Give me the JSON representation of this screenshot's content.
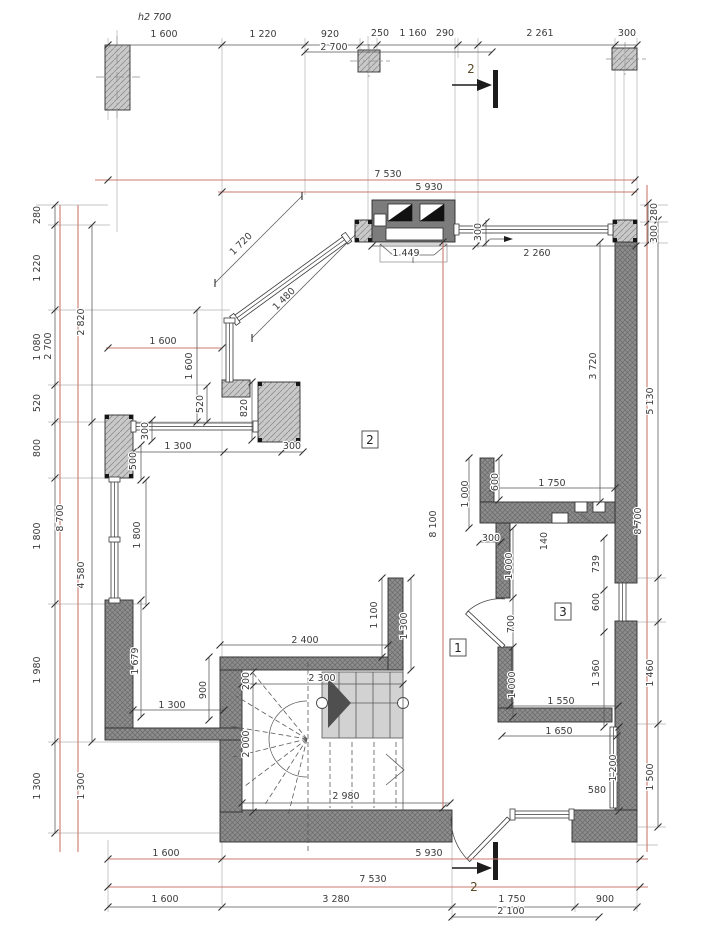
{
  "title": {
    "text": "h2 700",
    "x": 138,
    "y": 20
  },
  "rooms": [
    {
      "label": "2",
      "x": 370,
      "y": 444
    },
    {
      "label": "1",
      "x": 458,
      "y": 652
    },
    {
      "label": "3",
      "x": 563,
      "y": 616
    }
  ],
  "sections": [
    {
      "label": "2",
      "x": 471,
      "y": 73
    },
    {
      "label": "2",
      "x": 474,
      "y": 891
    }
  ],
  "colors": {
    "wall_fill": "#8d8d8d",
    "wall_hatch": "#6a6a6a",
    "pier_fill": "#c9c9c9",
    "pier_hatch": "#8f8f8f",
    "tread_fill": "#d2d2d2",
    "reference_red": "#c97b6d",
    "dim_text": "#3b3b3b",
    "dim_line": "#555555"
  },
  "dims": [
    {
      "t": "1 600",
      "x": 164,
      "y": 37
    },
    {
      "t": "1 220",
      "x": 263,
      "y": 37
    },
    {
      "t": "920",
      "x": 330,
      "y": 37
    },
    {
      "t": "2 700",
      "x": 334,
      "y": 50
    },
    {
      "t": "250",
      "x": 380,
      "y": 36
    },
    {
      "t": "1 160",
      "x": 413,
      "y": 36
    },
    {
      "t": "290",
      "x": 445,
      "y": 36
    },
    {
      "t": "2 261",
      "x": 540,
      "y": 36
    },
    {
      "t": "300",
      "x": 627,
      "y": 36
    },
    {
      "t": "7 530",
      "x": 388,
      "y": 177
    },
    {
      "t": "5 930",
      "x": 429,
      "y": 190
    },
    {
      "t": "1 449",
      "x": 406,
      "y": 256
    },
    {
      "t": "2 260",
      "x": 537,
      "y": 256
    },
    {
      "t": "300",
      "x": 481,
      "y": 232,
      "r": -90
    },
    {
      "t": "280",
      "x": 657,
      "y": 212,
      "r": -90
    },
    {
      "t": "300",
      "x": 657,
      "y": 234,
      "r": -90
    },
    {
      "t": "3 720",
      "x": 596,
      "y": 366,
      "r": -90
    },
    {
      "t": "5 130",
      "x": 653,
      "y": 401,
      "r": -90
    },
    {
      "t": "8 700",
      "x": 641,
      "y": 521,
      "r": -90
    },
    {
      "t": "739",
      "x": 599,
      "y": 564,
      "r": -90
    },
    {
      "t": "600",
      "x": 599,
      "y": 602,
      "r": -90
    },
    {
      "t": "1 360",
      "x": 599,
      "y": 673,
      "r": -90
    },
    {
      "t": "1 460",
      "x": 653,
      "y": 673,
      "r": -90
    },
    {
      "t": "1 200",
      "x": 616,
      "y": 768,
      "r": -90
    },
    {
      "t": "1 500",
      "x": 653,
      "y": 777,
      "r": -90
    },
    {
      "t": "580",
      "x": 597,
      "y": 793
    },
    {
      "t": "280",
      "x": 40,
      "y": 215,
      "r": -90
    },
    {
      "t": "1 220",
      "x": 40,
      "y": 268,
      "r": -90
    },
    {
      "t": "1 080",
      "x": 40,
      "y": 347,
      "r": -90
    },
    {
      "t": "2 700",
      "x": 51,
      "y": 346,
      "r": -90
    },
    {
      "t": "2 820",
      "x": 84,
      "y": 322,
      "r": -90
    },
    {
      "t": "520",
      "x": 40,
      "y": 403,
      "r": -90
    },
    {
      "t": "800",
      "x": 40,
      "y": 448,
      "r": -90
    },
    {
      "t": "1 800",
      "x": 40,
      "y": 536,
      "r": -90
    },
    {
      "t": "8 700",
      "x": 63,
      "y": 518,
      "r": -90
    },
    {
      "t": "4 580",
      "x": 84,
      "y": 575,
      "r": -90
    },
    {
      "t": "1 980",
      "x": 40,
      "y": 670,
      "r": -90
    },
    {
      "t": "1 300",
      "x": 40,
      "y": 786,
      "r": -90
    },
    {
      "t": "1 300",
      "x": 84,
      "y": 786,
      "r": -90
    },
    {
      "t": "1 600",
      "x": 163,
      "y": 344
    },
    {
      "t": "1 600",
      "x": 192,
      "y": 366,
      "r": -90
    },
    {
      "t": "520",
      "x": 203,
      "y": 404,
      "r": -90
    },
    {
      "t": "820",
      "x": 247,
      "y": 408,
      "r": -90
    },
    {
      "t": "300",
      "x": 148,
      "y": 431,
      "r": -90
    },
    {
      "t": "1 300",
      "x": 178,
      "y": 449
    },
    {
      "t": "300",
      "x": 292,
      "y": 449
    },
    {
      "t": "500",
      "x": 136,
      "y": 461,
      "r": -90
    },
    {
      "t": "1 800",
      "x": 140,
      "y": 535,
      "r": -90
    },
    {
      "t": "1 679",
      "x": 138,
      "y": 661,
      "r": -90
    },
    {
      "t": "900",
      "x": 206,
      "y": 690,
      "r": -90
    },
    {
      "t": "1 300",
      "x": 172,
      "y": 708
    },
    {
      "t": "1 720",
      "x": 243,
      "y": 246,
      "r": -45
    },
    {
      "t": "1 480",
      "x": 286,
      "y": 301,
      "r": -45
    },
    {
      "t": "2 400",
      "x": 305,
      "y": 643
    },
    {
      "t": "1 100",
      "x": 377,
      "y": 615,
      "r": -90
    },
    {
      "t": "1 300",
      "x": 407,
      "y": 626,
      "r": -90
    },
    {
      "t": "2 300",
      "x": 322,
      "y": 681
    },
    {
      "t": "200",
      "x": 249,
      "y": 681,
      "r": -90
    },
    {
      "t": "2 000",
      "x": 249,
      "y": 744,
      "r": -90
    },
    {
      "t": "2 980",
      "x": 346,
      "y": 799
    },
    {
      "t": "8 100",
      "x": 436,
      "y": 524,
      "r": -90
    },
    {
      "t": "1 000",
      "x": 468,
      "y": 494,
      "r": -90
    },
    {
      "t": "600",
      "x": 498,
      "y": 482,
      "r": -90
    },
    {
      "t": "1 750",
      "x": 552,
      "y": 486
    },
    {
      "t": "300",
      "x": 491,
      "y": 541
    },
    {
      "t": "140",
      "x": 547,
      "y": 541,
      "r": -90
    },
    {
      "t": "1 000",
      "x": 512,
      "y": 566,
      "r": -90
    },
    {
      "t": "700",
      "x": 514,
      "y": 624,
      "r": -90
    },
    {
      "t": "1 000",
      "x": 515,
      "y": 685,
      "r": -90
    },
    {
      "t": "1 550",
      "x": 561,
      "y": 704
    },
    {
      "t": "1 650",
      "x": 559,
      "y": 734
    },
    {
      "t": "1 600",
      "x": 166,
      "y": 856
    },
    {
      "t": "5 930",
      "x": 429,
      "y": 856
    },
    {
      "t": "7 530",
      "x": 373,
      "y": 882
    },
    {
      "t": "1 600",
      "x": 165,
      "y": 902
    },
    {
      "t": "3 280",
      "x": 336,
      "y": 902
    },
    {
      "t": "1 750",
      "x": 512,
      "y": 902
    },
    {
      "t": "900",
      "x": 605,
      "y": 902
    },
    {
      "t": "2 100",
      "x": 511,
      "y": 914
    }
  ],
  "dim_lines": [
    {
      "o": "h",
      "p": 45,
      "a": 108,
      "b": 637,
      "t": [
        108,
        222,
        305,
        360,
        377,
        458,
        478,
        615,
        637
      ]
    },
    {
      "o": "h",
      "p": 52,
      "a": 305,
      "b": 492,
      "t": [
        305,
        492
      ]
    },
    {
      "o": "h",
      "p": 180,
      "a": 95,
      "b": 637,
      "t": [
        108,
        635
      ],
      "c": 1
    },
    {
      "o": "h",
      "p": 192,
      "a": 218,
      "b": 637,
      "t": [
        222,
        635
      ],
      "c": 1
    },
    {
      "o": "h",
      "p": 246,
      "a": 372,
      "b": 636,
      "t": [
        372,
        476,
        636
      ]
    },
    {
      "o": "h",
      "p": 348,
      "a": 106,
      "b": 222,
      "t": [
        108,
        222
      ],
      "c": 1
    },
    {
      "o": "h",
      "p": 452,
      "a": 133,
      "b": 303,
      "t": [
        133,
        224,
        282,
        303
      ]
    },
    {
      "o": "h",
      "p": 645,
      "a": 220,
      "b": 388,
      "t": [
        220,
        388
      ]
    },
    {
      "o": "h",
      "p": 684,
      "a": 242,
      "b": 403,
      "t": [
        242,
        403
      ]
    },
    {
      "o": "h",
      "p": 710,
      "a": 133,
      "b": 224,
      "t": [
        133,
        224
      ]
    },
    {
      "o": "h",
      "p": 803,
      "a": 242,
      "b": 450,
      "t": [
        242,
        450
      ]
    },
    {
      "o": "h",
      "p": 488,
      "a": 493,
      "b": 615,
      "t": [
        493,
        615
      ]
    },
    {
      "o": "h",
      "p": 542,
      "a": 480,
      "b": 501,
      "t": [
        480,
        501
      ]
    },
    {
      "o": "h",
      "p": 706,
      "a": 510,
      "b": 618,
      "t": [
        510,
        618
      ]
    },
    {
      "o": "h",
      "p": 736,
      "a": 502,
      "b": 617,
      "t": [
        502,
        617
      ]
    },
    {
      "o": "h",
      "p": 859,
      "a": 108,
      "b": 648,
      "t": [
        108,
        222,
        640
      ],
      "c": 1
    },
    {
      "o": "h",
      "p": 887,
      "a": 108,
      "b": 648,
      "t": [
        108,
        640
      ],
      "c": 1
    },
    {
      "o": "h",
      "p": 907,
      "a": 108,
      "b": 637,
      "t": [
        108,
        222,
        452,
        575,
        637
      ]
    },
    {
      "o": "h",
      "p": 917,
      "a": 452,
      "b": 599,
      "t": [
        452,
        599
      ]
    },
    {
      "o": "v",
      "p": 55,
      "a": 205,
      "b": 833,
      "t": [
        205,
        225,
        310,
        385,
        422,
        478,
        604,
        742,
        833
      ]
    },
    {
      "o": "v",
      "p": 60,
      "a": 205,
      "b": 852,
      "t": [],
      "c": 1
    },
    {
      "o": "v",
      "p": 78,
      "a": 205,
      "b": 852,
      "t": [],
      "c": 1
    },
    {
      "o": "v",
      "p": 92,
      "a": 225,
      "b": 742,
      "t": [
        225,
        422,
        742
      ]
    },
    {
      "o": "v",
      "p": 658,
      "a": 220,
      "b": 827,
      "t": [
        220,
        578,
        622,
        724,
        827
      ]
    },
    {
      "o": "v",
      "p": 647,
      "a": 185,
      "b": 852,
      "t": [],
      "c": 1
    },
    {
      "o": "v",
      "p": 600,
      "a": 242,
      "b": 502,
      "t": [
        242,
        502
      ]
    },
    {
      "o": "v",
      "p": 604,
      "a": 538,
      "b": 727,
      "t": [
        538,
        590,
        632,
        727
      ]
    },
    {
      "o": "v",
      "p": 619,
      "a": 727,
      "b": 811,
      "t": [
        727,
        811
      ]
    },
    {
      "o": "v",
      "p": 648,
      "a": 203,
      "b": 243,
      "t": [
        203,
        222,
        243
      ]
    },
    {
      "o": "v",
      "p": 469,
      "a": 458,
      "b": 528,
      "t": [
        458,
        528
      ]
    },
    {
      "o": "v",
      "p": 499,
      "a": 458,
      "b": 500,
      "t": [
        458,
        500
      ]
    },
    {
      "o": "v",
      "p": 513,
      "a": 528,
      "b": 717,
      "t": [
        528,
        598,
        647,
        717
      ]
    },
    {
      "o": "v",
      "p": 382,
      "a": 578,
      "b": 657,
      "t": [
        578,
        657
      ]
    },
    {
      "o": "v",
      "p": 411,
      "a": 578,
      "b": 670,
      "t": [
        578,
        670
      ]
    },
    {
      "o": "v",
      "p": 253,
      "a": 672,
      "b": 812,
      "t": [
        672,
        686,
        812
      ]
    },
    {
      "o": "v",
      "p": 141,
      "a": 600,
      "b": 717,
      "t": [
        600,
        717
      ]
    },
    {
      "o": "v",
      "p": 209,
      "a": 657,
      "b": 720,
      "t": [
        657,
        720
      ]
    },
    {
      "o": "v",
      "p": 197,
      "a": 310,
      "b": 422,
      "t": [
        310,
        422
      ]
    },
    {
      "o": "v",
      "p": 207,
      "a": 386,
      "b": 422,
      "t": [
        386,
        422
      ]
    },
    {
      "o": "v",
      "p": 252,
      "a": 382,
      "b": 440,
      "t": [
        382,
        440
      ]
    },
    {
      "o": "v",
      "p": 152,
      "a": 420,
      "b": 441,
      "t": [
        420,
        441
      ]
    },
    {
      "o": "v",
      "p": 141,
      "a": 445,
      "b": 480,
      "t": [
        445,
        480
      ]
    },
    {
      "o": "v",
      "p": 146,
      "a": 480,
      "b": 606,
      "t": [
        480,
        606
      ]
    },
    {
      "o": "v",
      "p": 443,
      "a": 242,
      "b": 808,
      "t": [
        242,
        808
      ],
      "c": 1
    },
    {
      "o": "v",
      "p": 486,
      "a": 220,
      "b": 246,
      "t": [
        222,
        243
      ]
    },
    {
      "o": "d",
      "x1": 215,
      "y1": 283,
      "x2": 302,
      "y2": 196
    },
    {
      "o": "d",
      "x1": 252,
      "y1": 338,
      "x2": 355,
      "y2": 235
    }
  ]
}
